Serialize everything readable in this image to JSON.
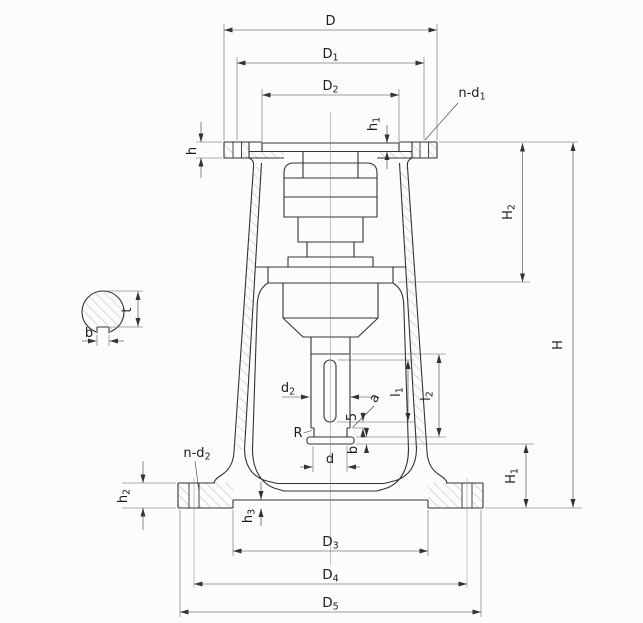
{
  "drawing": {
    "kind": "technical section drawing of a flanged screw-support column",
    "colors": {
      "line": "#333333",
      "thin": "#5a5a5a",
      "hatch": "#9a9a9a",
      "background": "#fcfcfc"
    }
  },
  "labels": {
    "top": {
      "D": "D",
      "D1": "D1",
      "D2": "D2",
      "h1": "h1",
      "n_d1": "n-d1",
      "h": "h"
    },
    "right": {
      "H2": "H2",
      "H": "H",
      "H1": "H1"
    },
    "center": {
      "d2": "d2",
      "R": "R",
      "gap": "5",
      "a": "a",
      "b": "b",
      "d": "d",
      "l1": "l1",
      "l2": "l2"
    },
    "bottom": {
      "n_d2": "n-d2",
      "h2": "h2",
      "h3": "h3",
      "D3": "D3",
      "D4": "D4",
      "D5": "D5"
    },
    "key_detail": {
      "t": "t",
      "b": "b"
    }
  }
}
